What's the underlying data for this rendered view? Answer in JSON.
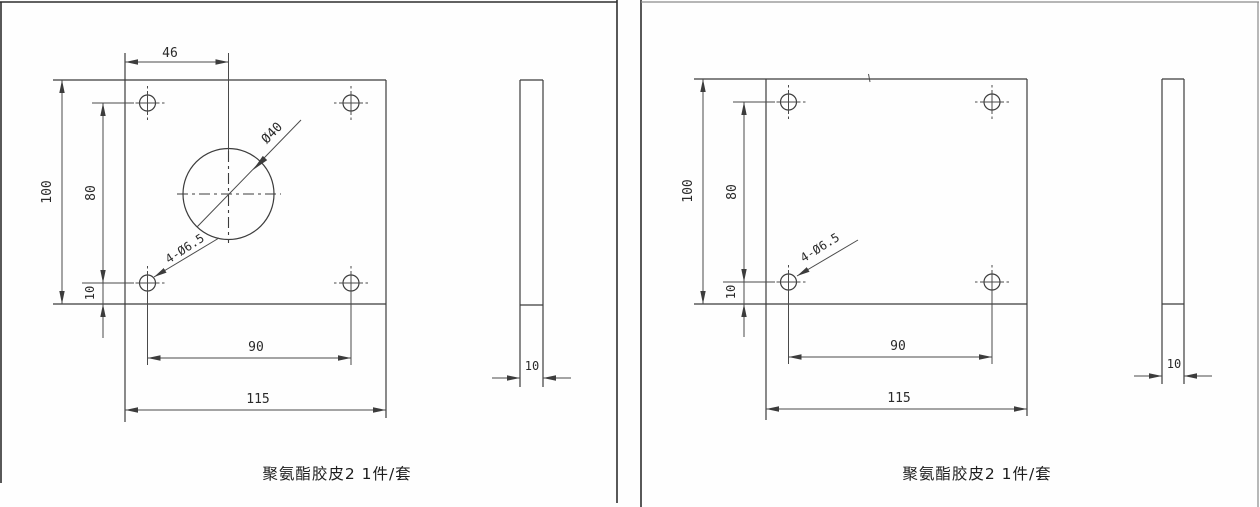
{
  "page": {
    "background": "#fefefe",
    "line_color": "#3c3c3c"
  },
  "panels": [
    {
      "caption": "聚氨酯胶皮2 1件/套",
      "front_view": {
        "dim_hole_offset_top": "46",
        "dim_height": "100",
        "dim_hole_span_vertical": "80",
        "dim_hole_offset_bottom": "10",
        "dim_hole_span_horizontal": "90",
        "dim_width": "115",
        "center_hole_label": "Ø40",
        "corner_holes_label": "4-Ø6.5"
      },
      "side_view": {
        "dim_thickness": "10"
      }
    },
    {
      "caption": "聚氨酯胶皮2 1件/套",
      "front_view": {
        "dim_height": "100",
        "dim_hole_span_vertical": "80",
        "dim_hole_offset_bottom": "10",
        "dim_hole_span_horizontal": "90",
        "dim_width": "115",
        "corner_holes_label": "4-Ø6.5"
      },
      "side_view": {
        "dim_thickness": "10"
      }
    }
  ]
}
